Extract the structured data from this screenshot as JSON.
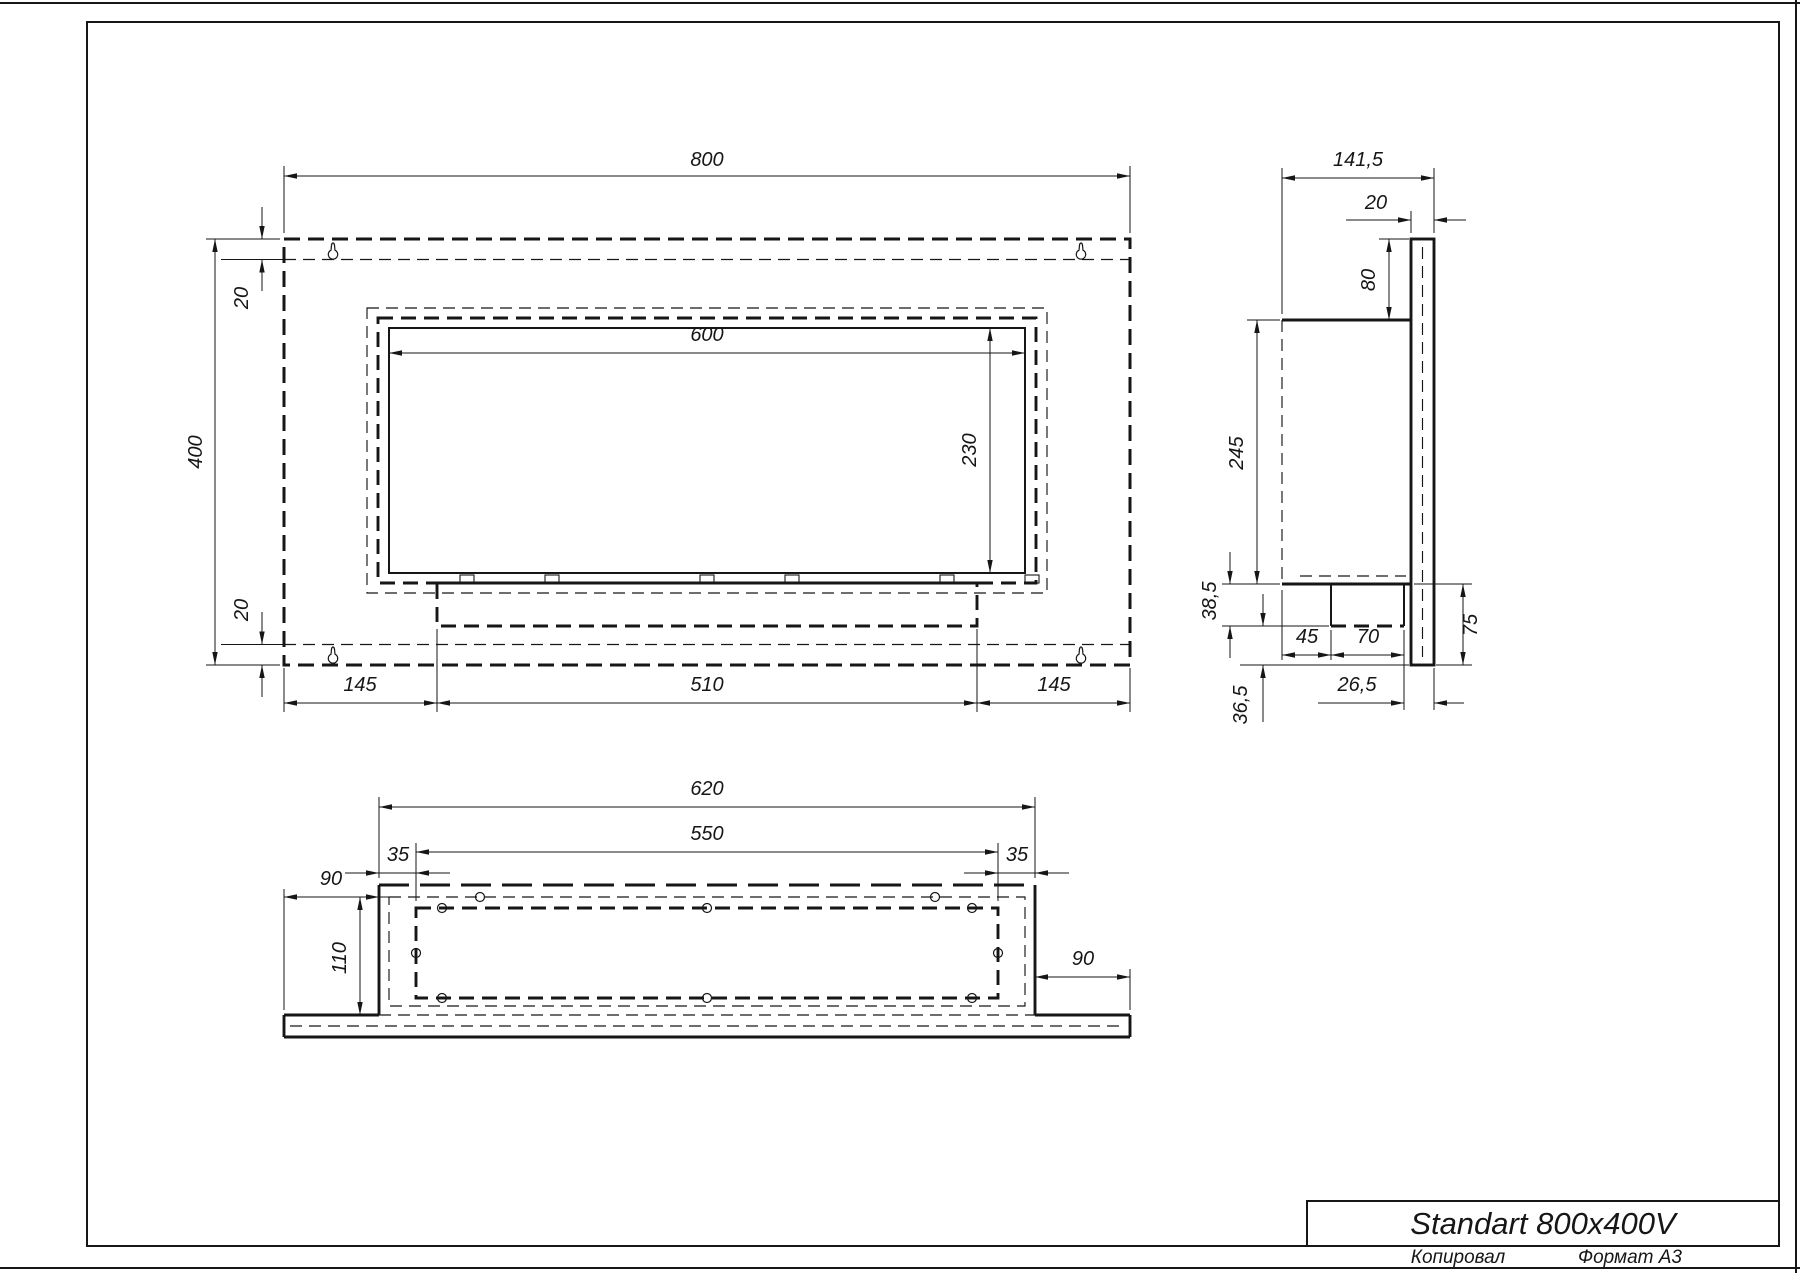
{
  "sheet": {
    "kind": "technical-drawing",
    "format_note": "A3 landscape engineering drawing, black lines on white"
  },
  "title_block": {
    "product": "Standart 800x400V"
  },
  "footer": {
    "copied": "Копировал",
    "format": "Формат А3"
  },
  "front_view": {
    "dims": {
      "overall_width": "800",
      "overall_height": "400",
      "top_flange": "20",
      "bottom_flange": "20",
      "opening_width": "600",
      "opening_height": "230",
      "tray_left_margin": "145",
      "tray_width": "510",
      "tray_right_margin": "145"
    }
  },
  "side_view": {
    "dims": {
      "overall_depth": "141,5",
      "panel_thickness": "20",
      "box_top_offset": "80",
      "box_height": "245",
      "tray_height": "38,5",
      "below_tray": "36,5",
      "tray_setback": "45",
      "tray_depth": "70",
      "tray_back_gap": "26,5",
      "panel_below_box": "75"
    }
  },
  "bottom_view": {
    "dims": {
      "box_width": "620",
      "mount_hole_span": "550",
      "left_inset": "35",
      "right_inset": "35",
      "left_flange": "90",
      "right_flange": "90",
      "inner_depth": "110"
    }
  }
}
